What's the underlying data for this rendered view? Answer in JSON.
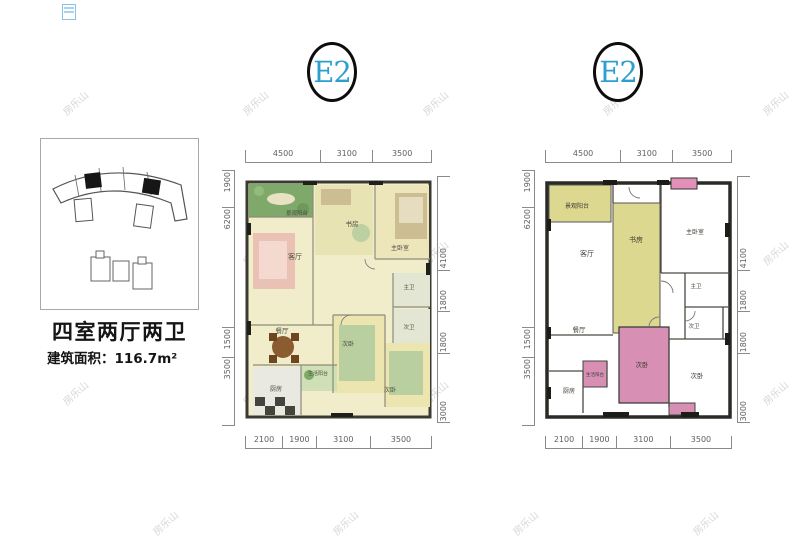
{
  "watermark": {
    "text": "房乐山"
  },
  "icons": {
    "corner_mark": "blue-stamp-icon"
  },
  "badges": {
    "left": "E2",
    "right": "E2"
  },
  "info": {
    "layout_title": "四室两厅两卫",
    "area_label": "建筑面积：",
    "area_value": "116.7m²"
  },
  "left_plan": {
    "style": "rendered color floor plan",
    "dims": {
      "top": [
        "4500",
        "3100",
        "3500"
      ],
      "bottom": [
        "2100",
        "1900",
        "3100",
        "3500"
      ],
      "left": [
        "1900",
        "6200",
        "1500",
        "3500"
      ],
      "right": [
        "4100",
        "1800",
        "1800",
        "3000"
      ]
    },
    "rooms": {
      "balcony": "景观阳台",
      "study": "书房",
      "master_bedroom": "主卧室",
      "living": "客厅",
      "master_bath": "主卫",
      "bath2": "次卫",
      "dining": "餐厅",
      "bedroom2": "次卧",
      "bedroom3": "次卧",
      "kitchen": "厨房",
      "service_balcony": "生活阳台"
    }
  },
  "right_plan": {
    "style": "schematic line floor plan",
    "dims": {
      "top": [
        "4500",
        "3100",
        "3500"
      ],
      "bottom": [
        "2100",
        "1900",
        "3100",
        "3500"
      ],
      "left": [
        "1900",
        "6200",
        "1500",
        "3500"
      ],
      "right": [
        "4100",
        "1800",
        "1800",
        "3000"
      ]
    },
    "rooms": {
      "balcony": "景观阳台",
      "study": "书房",
      "master_bedroom": "主卧室",
      "living": "客厅",
      "master_bath": "主卫",
      "bath2": "次卫",
      "dining": "餐厅",
      "bedroom2": "次卧",
      "bedroom3": "次卧",
      "kitchen": "厨房",
      "service_balcony": "生活阳台"
    }
  }
}
